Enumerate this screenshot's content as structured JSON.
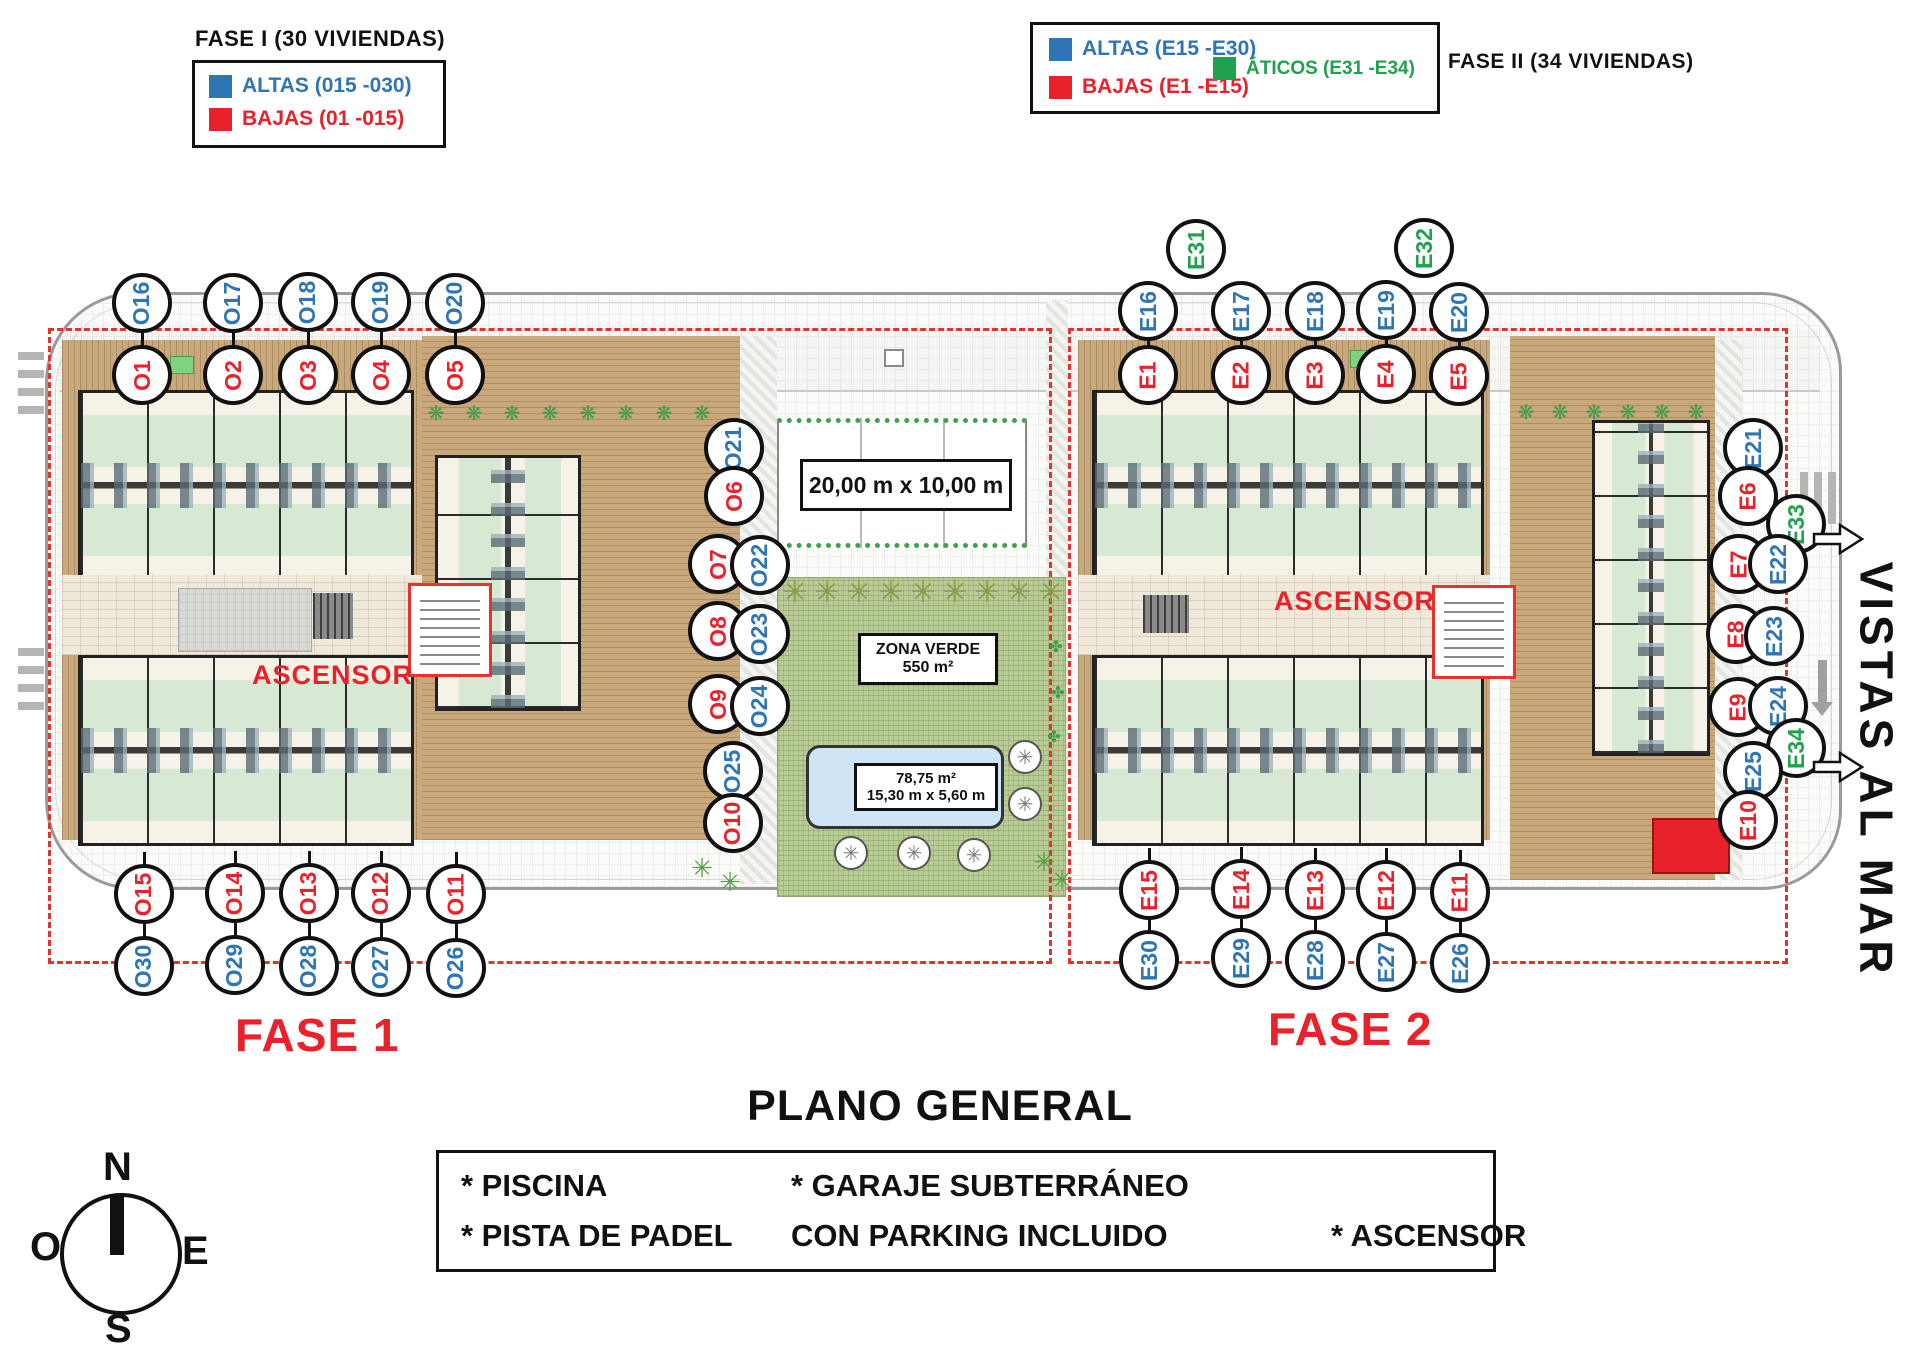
{
  "colors": {
    "blue": "#2e75b6",
    "red": "#e8212a",
    "green": "#1fa14e",
    "dash": "#e0342f"
  },
  "legend_fase1": {
    "title": "FASE I (30 VIVIENDAS)",
    "items": [
      {
        "label": "ALTAS (015 -030)",
        "color": "blue"
      },
      {
        "label": "BAJAS (01 -015)",
        "color": "red"
      }
    ]
  },
  "legend_fase2": {
    "title": "FASE II (34 VIVIENDAS)",
    "items": [
      {
        "label": "ALTAS (E15 -E30)",
        "color": "blue"
      },
      {
        "label": "BAJAS (E1 -E15)",
        "color": "red"
      },
      {
        "label": "ÁTICOS (E31 -E34)",
        "color": "green"
      }
    ]
  },
  "plan": {
    "padel_label": "20,00 m x 10,00 m",
    "zona_verde": {
      "line1": "ZONA VERDE",
      "line2": "550 m²"
    },
    "pool": {
      "line1": "78,75 m²",
      "line2": "15,30 m x 5,60 m"
    },
    "ascensor_fase1": "ASCENSOR",
    "ascensor_fase2": "ASCENSOR",
    "vistas": "VISTAS AL MAR",
    "fase1_label": "FASE 1",
    "fase2_label": "FASE 2"
  },
  "circles": [
    {
      "label": "O16",
      "x": 142,
      "y": 303,
      "color": "blue"
    },
    {
      "label": "O17",
      "x": 233,
      "y": 303,
      "color": "blue"
    },
    {
      "label": "O18",
      "x": 308,
      "y": 302,
      "color": "blue"
    },
    {
      "label": "O19",
      "x": 381,
      "y": 302,
      "color": "blue"
    },
    {
      "label": "O20",
      "x": 455,
      "y": 303,
      "color": "blue"
    },
    {
      "label": "O1",
      "x": 142,
      "y": 375,
      "color": "red"
    },
    {
      "label": "O2",
      "x": 233,
      "y": 375,
      "color": "red"
    },
    {
      "label": "O3",
      "x": 308,
      "y": 375,
      "color": "red"
    },
    {
      "label": "O4",
      "x": 381,
      "y": 375,
      "color": "red"
    },
    {
      "label": "O5",
      "x": 455,
      "y": 375,
      "color": "red"
    },
    {
      "label": "O21",
      "x": 734,
      "y": 448,
      "color": "blue"
    },
    {
      "label": "O6",
      "x": 734,
      "y": 496,
      "color": "red"
    },
    {
      "label": "O7",
      "x": 718,
      "y": 564,
      "color": "red"
    },
    {
      "label": "O22",
      "x": 760,
      "y": 565,
      "color": "blue"
    },
    {
      "label": "O8",
      "x": 718,
      "y": 631,
      "color": "red"
    },
    {
      "label": "O23",
      "x": 760,
      "y": 634,
      "color": "blue"
    },
    {
      "label": "O9",
      "x": 718,
      "y": 704,
      "color": "red"
    },
    {
      "label": "O24",
      "x": 760,
      "y": 706,
      "color": "blue"
    },
    {
      "label": "O25",
      "x": 733,
      "y": 771,
      "color": "blue"
    },
    {
      "label": "O10",
      "x": 733,
      "y": 823,
      "color": "red"
    },
    {
      "label": "O15",
      "x": 144,
      "y": 894,
      "color": "red"
    },
    {
      "label": "O14",
      "x": 235,
      "y": 893,
      "color": "red"
    },
    {
      "label": "O13",
      "x": 309,
      "y": 893,
      "color": "red"
    },
    {
      "label": "O12",
      "x": 381,
      "y": 893,
      "color": "red"
    },
    {
      "label": "O11",
      "x": 456,
      "y": 894,
      "color": "red"
    },
    {
      "label": "O30",
      "x": 144,
      "y": 966,
      "color": "blue"
    },
    {
      "label": "O29",
      "x": 235,
      "y": 965,
      "color": "blue"
    },
    {
      "label": "O28",
      "x": 309,
      "y": 966,
      "color": "blue"
    },
    {
      "label": "O27",
      "x": 381,
      "y": 967,
      "color": "blue"
    },
    {
      "label": "O26",
      "x": 456,
      "y": 968,
      "color": "blue"
    },
    {
      "label": "E31",
      "x": 1196,
      "y": 249,
      "color": "green"
    },
    {
      "label": "E32",
      "x": 1424,
      "y": 248,
      "color": "green"
    },
    {
      "label": "E16",
      "x": 1148,
      "y": 311,
      "color": "blue"
    },
    {
      "label": "E17",
      "x": 1241,
      "y": 311,
      "color": "blue"
    },
    {
      "label": "E18",
      "x": 1315,
      "y": 311,
      "color": "blue"
    },
    {
      "label": "E19",
      "x": 1386,
      "y": 310,
      "color": "blue"
    },
    {
      "label": "E20",
      "x": 1459,
      "y": 312,
      "color": "blue"
    },
    {
      "label": "E1",
      "x": 1148,
      "y": 375,
      "color": "red"
    },
    {
      "label": "E2",
      "x": 1241,
      "y": 375,
      "color": "red"
    },
    {
      "label": "E3",
      "x": 1315,
      "y": 375,
      "color": "red"
    },
    {
      "label": "E4",
      "x": 1386,
      "y": 374,
      "color": "red"
    },
    {
      "label": "E5",
      "x": 1459,
      "y": 376,
      "color": "red"
    },
    {
      "label": "E21",
      "x": 1753,
      "y": 448,
      "color": "blue"
    },
    {
      "label": "E6",
      "x": 1748,
      "y": 496,
      "color": "red"
    },
    {
      "label": "E33",
      "x": 1796,
      "y": 524,
      "color": "green"
    },
    {
      "label": "E7",
      "x": 1739,
      "y": 564,
      "color": "red"
    },
    {
      "label": "E22",
      "x": 1778,
      "y": 564,
      "color": "blue"
    },
    {
      "label": "E8",
      "x": 1736,
      "y": 634,
      "color": "red"
    },
    {
      "label": "E23",
      "x": 1774,
      "y": 636,
      "color": "blue"
    },
    {
      "label": "E9",
      "x": 1738,
      "y": 707,
      "color": "red"
    },
    {
      "label": "E24",
      "x": 1778,
      "y": 706,
      "color": "blue"
    },
    {
      "label": "E34",
      "x": 1796,
      "y": 748,
      "color": "green"
    },
    {
      "label": "E25",
      "x": 1753,
      "y": 771,
      "color": "blue"
    },
    {
      "label": "E10",
      "x": 1748,
      "y": 820,
      "color": "red"
    },
    {
      "label": "E15",
      "x": 1149,
      "y": 890,
      "color": "red"
    },
    {
      "label": "E14",
      "x": 1241,
      "y": 889,
      "color": "red"
    },
    {
      "label": "E13",
      "x": 1315,
      "y": 890,
      "color": "red"
    },
    {
      "label": "E12",
      "x": 1386,
      "y": 890,
      "color": "red"
    },
    {
      "label": "E11",
      "x": 1460,
      "y": 892,
      "color": "red"
    },
    {
      "label": "E30",
      "x": 1149,
      "y": 960,
      "color": "blue"
    },
    {
      "label": "E29",
      "x": 1241,
      "y": 958,
      "color": "blue"
    },
    {
      "label": "E28",
      "x": 1315,
      "y": 960,
      "color": "blue"
    },
    {
      "label": "E27",
      "x": 1386,
      "y": 962,
      "color": "blue"
    },
    {
      "label": "E26",
      "x": 1460,
      "y": 963,
      "color": "blue"
    }
  ],
  "pairs_top": [
    [
      "O16",
      "O1"
    ],
    [
      "O17",
      "O2"
    ],
    [
      "O18",
      "O3"
    ],
    [
      "O19",
      "O4"
    ],
    [
      "O20",
      "O5"
    ],
    [
      "E16",
      "E1"
    ],
    [
      "E17",
      "E2"
    ],
    [
      "E18",
      "E3"
    ],
    [
      "E19",
      "E4"
    ],
    [
      "E20",
      "E5"
    ]
  ],
  "pairs_bottom": [
    [
      "O15",
      "O30"
    ],
    [
      "O14",
      "O29"
    ],
    [
      "O13",
      "O28"
    ],
    [
      "O12",
      "O27"
    ],
    [
      "O11",
      "O26"
    ],
    [
      "E15",
      "E30"
    ],
    [
      "E14",
      "E29"
    ],
    [
      "E13",
      "E28"
    ],
    [
      "E12",
      "E27"
    ],
    [
      "E11",
      "E26"
    ]
  ],
  "footer": {
    "title": "PLANO GENERAL",
    "feature_piscina": "* PISCINA",
    "feature_padel": "* PISTA DE PADEL",
    "feature_garaje": "* GARAJE SUBTERRÁNEO",
    "feature_parking": "CON PARKING INCLUIDO",
    "feature_ascensor": "* ASCENSOR"
  },
  "compass": {
    "n": "N",
    "s": "S",
    "e": "E",
    "o": "O"
  }
}
